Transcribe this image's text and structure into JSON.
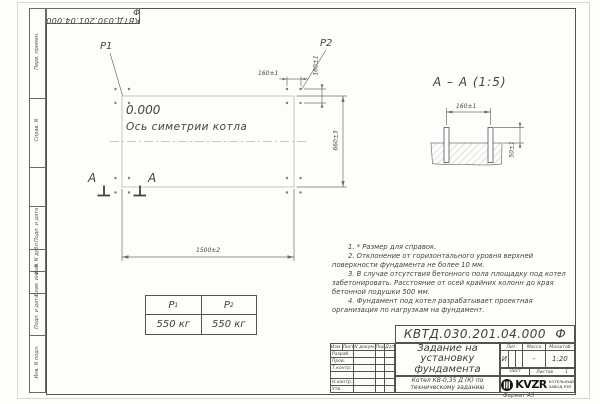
{
  "corner_stamp": {
    "doc_number": "КВТД.030.201.04.000  Ф"
  },
  "margin": {
    "top_fields": [
      "Перв. примен.",
      "Справ. N"
    ],
    "bottom_fields": [
      "Подп. и дата",
      "Инв. N дубл.",
      "Взам. инв. N",
      "Подп. и дата",
      "Инв. N подл."
    ]
  },
  "plan": {
    "p1": "Р1",
    "p2": "Р2",
    "elevation": "0.000",
    "axis_label": "Ось симетрии котла",
    "section_letter_left": "А",
    "section_letter_right": "А",
    "dim_bolt_spacing_h": "160±1",
    "dim_bolt_spacing_v": "160±1",
    "dim_height": "660±3",
    "dim_width": "1500±2"
  },
  "section_view": {
    "title": "А – А (1:5)",
    "dim_spacing": "160±1",
    "dim_protrusion": "50±1"
  },
  "notes": [
    "1. * Размер для справок.",
    "2. Отклонение от горизонтального уровня верхней поверхности фундамента не более 10 мм.",
    "3. В случае отсутствия бетонного пола площадку под котел забетонировать. Расстояние от осей крайних колонн до края бетонной подушки 500 мм.",
    "4. Фундамент под котел разрабатывает проектная организация по нагрузкам на фундамент."
  ],
  "load_table": {
    "col1_header": "Р",
    "col1_sub": "1",
    "col1_value": "550 кг",
    "col2_header": "Р",
    "col2_sub": "2",
    "col2_value": "550 кг"
  },
  "title_block": {
    "doc_number": "КВТД.030.201.04.000  Ф",
    "title": "Задание на установку фундамента",
    "subtitle": "Котел КВ-0,35 Д (К) по техническому заданию",
    "cols": [
      "Изм.",
      "Лист",
      "N докум.",
      "Подп.",
      "Дата"
    ],
    "rows": [
      "Разраб.",
      "Пров.",
      "Т.контр.",
      "",
      "Н.контр.",
      "Утв."
    ],
    "lit_label": "Лит.",
    "lit_value": "И",
    "mass_label": "Масса",
    "mass_value": "-",
    "scale_label": "Масштаб",
    "scale_value": "1:20",
    "sheet_label": "Лист",
    "sheets_label": "Листов",
    "sheets_value": "1",
    "brand": "KVZR",
    "brand_line1": "КОТЕЛЬНЫЙ",
    "brand_line2": "ЗАВОД РЭП",
    "format_label": "Формат А3"
  },
  "colors": {
    "line": "#55534d",
    "light_line": "#b6b5ae",
    "text": "#3b3b38",
    "logo": "#151515"
  }
}
